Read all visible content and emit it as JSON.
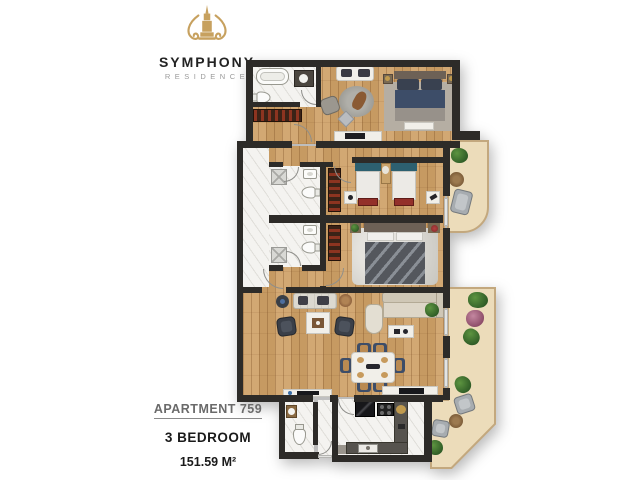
{
  "brand": {
    "name": "SYMPHONY",
    "subtitle": "RESIDENCE",
    "logo_color": "#c7a15f"
  },
  "apartment": {
    "title": "APARTMENT 759",
    "bedrooms": "3 BEDROOM",
    "area": "151.59 M²"
  },
  "colors": {
    "wall": "#2d2b28",
    "wood_floor": "#cba06a",
    "marble_floor": "#f4f3f0",
    "balcony_tile": "#ecdcba",
    "balcony_border": "#c3a87e",
    "accent_gold": "#c7a15f",
    "bed_navy": "#3d4d68",
    "wardrobe_brown": "#3b2317"
  }
}
